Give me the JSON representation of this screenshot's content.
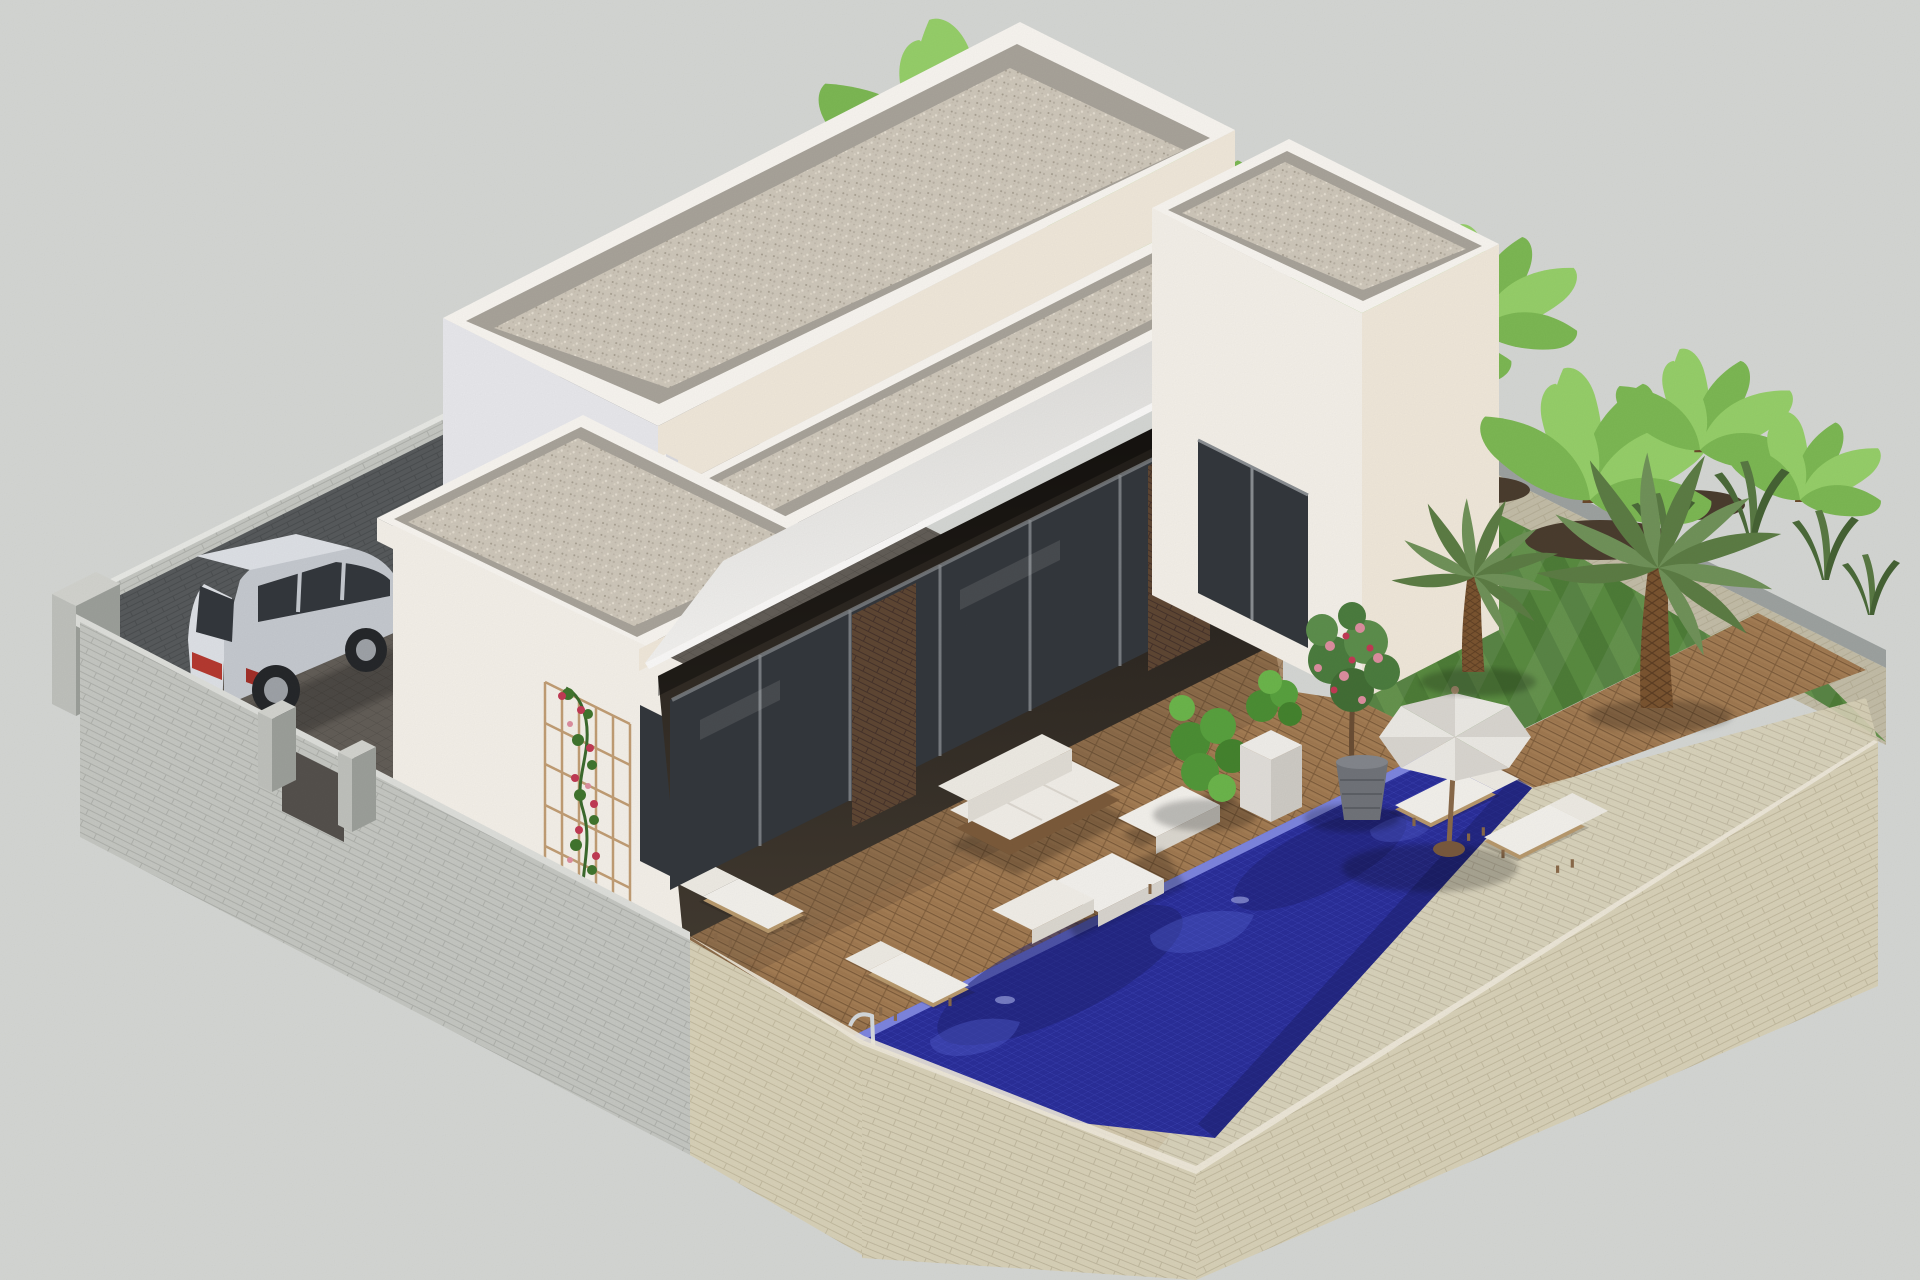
{
  "scene": {
    "title": "3D isometric architectural visualization of a modern single-storey villa with flat gravel roofs, sun deck, swimming pool and walled garden",
    "type": "computer generated exterior render",
    "objects": [
      "flat-roof villa with white parapets",
      "gravel covered flat roofs on three levels",
      "white sloping patio awning",
      "recessed terrace with dark sliding glass doors",
      "brown brick piers",
      "timber sun deck",
      "white outdoor sofa set with coffee table",
      "four white sun loungers",
      "white parasol with wooden pole",
      "deep-blue mosaic swimming pool with chrome ladder",
      "silver SUV parked on paver driveway",
      "grey concrete block boundary wall with gate posts",
      "cream stone perimeter wall with chamfered corner",
      "striped lawn with palm trees and banana plants",
      "climbing rose on timber trellis",
      "yellow flower bed",
      "potted pink-flowering tree and green shrubs",
      "white cube planter"
    ]
  },
  "palette": {
    "bg": "#d6d8d5",
    "wall_white_sw": "#f5f1ea",
    "wall_white_se": "#f1e9db",
    "wall_white_cool": "#e9e9ed",
    "parapet_top": "#f9f6f1",
    "parapet_shade": "#dcdce1",
    "roof_gravel": "#cfc8bb",
    "roof_band": "#a9a49b",
    "glass": "#34383d",
    "frame": "#8a8e92",
    "brick": "#5f4734",
    "deck": "#a57e55",
    "deck_gap": "#7d5c3b",
    "lawn": "#4e7d38",
    "lawn_hi": "#5a8c41",
    "pool": "#2b2f9a",
    "pool_deep": "#1e2170",
    "pool_hi": "#5560cf",
    "pool_edge": "#7e86e0",
    "beige_wall": "#d9d2b9",
    "beige_dark": "#cdc5aa",
    "coping_gray": "#9ea3a1",
    "block_light": "#c6c8c3",
    "block_dark": "#585b5d",
    "paver": "#605c57",
    "soil": "#4b3d2f",
    "trunk": "#7b5531",
    "palm": "#5d7d45",
    "palm_hi": "#71935a",
    "banana": "#7db954",
    "banana_hi": "#97d06a",
    "bush": "#3e7a33",
    "rose": "#c23b55",
    "rose_hi": "#de8fa0",
    "yellow": "#d8ca35",
    "car_body": "#c6cad0",
    "car_hi": "#dfe2e7",
    "chrome": "#d5dade",
    "umbrella": "#edebe6",
    "umbrella_shade": "#dad7d1",
    "wood": "#8a6a4a",
    "pot": "#71747a",
    "planter": "#f1efeb"
  }
}
